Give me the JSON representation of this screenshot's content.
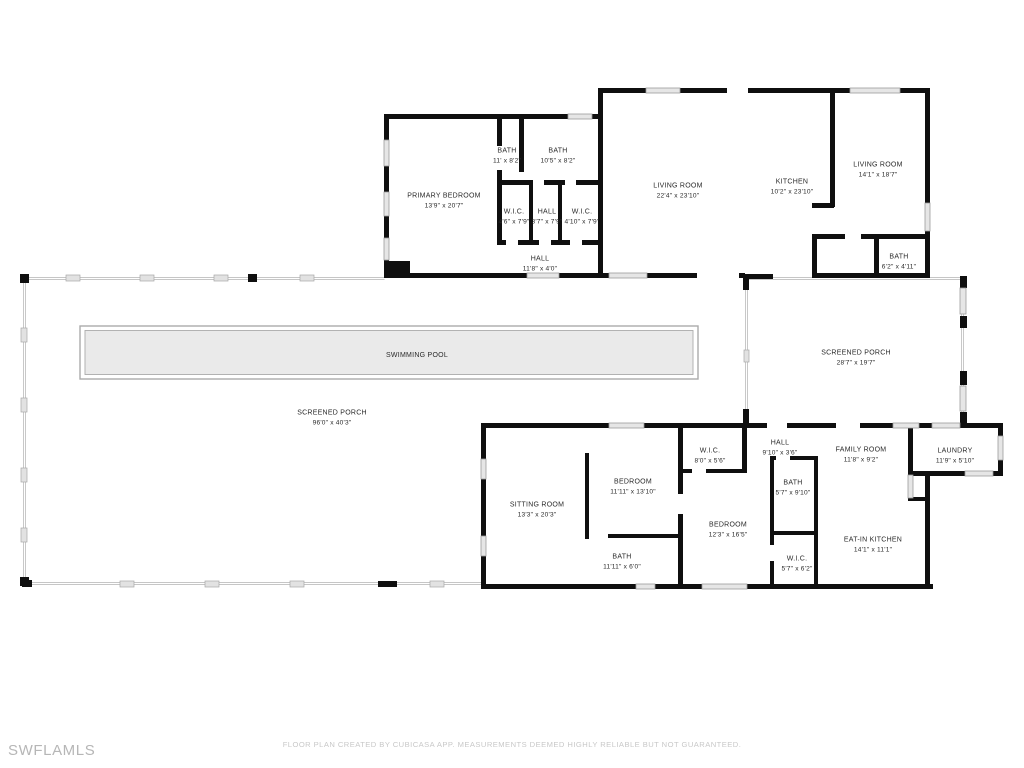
{
  "meta": {
    "watermark": "SWFLAMLS",
    "disclaimer": "FLOOR PLAN CREATED BY CUBICASA APP. MEASUREMENTS DEEMED HIGHLY RELIABLE BUT NOT GUARANTEED."
  },
  "colors": {
    "wall": "#0f0f0f",
    "window": "#e6e6e6",
    "window-frame": "#9c9c9c",
    "screen": "#c6c6c6",
    "pool-fill": "#eaeaea",
    "pool-line": "#ababab",
    "label": "#2a2a2a",
    "muted": "#c8c8c8",
    "watermark": "#b6b6b6",
    "bg": "#ffffff"
  },
  "rooms": [
    {
      "id": "primary-bedroom",
      "name": "PRIMARY BEDROOM",
      "dims": "13'9\" x 20'7\""
    },
    {
      "id": "bath-1",
      "name": "BATH",
      "dims": "11' x 8'2\""
    },
    {
      "id": "bath-2",
      "name": "BATH",
      "dims": "10'5\" x 8'2\""
    },
    {
      "id": "wic-1",
      "name": "W.I.C.",
      "dims": "4'6\" x 7'9\""
    },
    {
      "id": "hall-1",
      "name": "HALL",
      "dims": "3'7\" x 7'9\""
    },
    {
      "id": "wic-2",
      "name": "W.I.C.",
      "dims": "4'10\" x 7'9\""
    },
    {
      "id": "living-room-1",
      "name": "LIVING ROOM",
      "dims": "22'4\" x 23'10\""
    },
    {
      "id": "kitchen",
      "name": "KITCHEN",
      "dims": "10'2\" x 23'10\""
    },
    {
      "id": "living-room-2",
      "name": "LIVING ROOM",
      "dims": "14'1\" x 18'7\""
    },
    {
      "id": "bath-3",
      "name": "BATH",
      "dims": "6'2\" x 4'11\""
    },
    {
      "id": "hall-2",
      "name": "HALL",
      "dims": "11'8\" x 4'0\""
    },
    {
      "id": "swimming-pool",
      "name": "SWIMMING POOL",
      "dims": ""
    },
    {
      "id": "screened-porch-1",
      "name": "SCREENED PORCH",
      "dims": "96'0\" x 40'3\""
    },
    {
      "id": "screened-porch-2",
      "name": "SCREENED PORCH",
      "dims": "28'7\" x 19'7\""
    },
    {
      "id": "wic-3",
      "name": "W.I.C.",
      "dims": "8'0\" x 5'6\""
    },
    {
      "id": "hall-3",
      "name": "HALL",
      "dims": "9'10\" x 3'6\""
    },
    {
      "id": "family-room",
      "name": "FAMILY ROOM",
      "dims": "11'8\" x 9'2\""
    },
    {
      "id": "laundry",
      "name": "LAUNDRY",
      "dims": "11'9\" x 5'10\""
    },
    {
      "id": "bedroom-1",
      "name": "BEDROOM",
      "dims": "11'11\" x 13'10\""
    },
    {
      "id": "sitting-room",
      "name": "SITTING ROOM",
      "dims": "13'3\" x 20'3\""
    },
    {
      "id": "bath-4",
      "name": "BATH",
      "dims": "5'7\" x 9'10\""
    },
    {
      "id": "bedroom-2",
      "name": "BEDROOM",
      "dims": "12'3\" x 16'5\""
    },
    {
      "id": "bath-5",
      "name": "BATH",
      "dims": "11'11\" x 6'0\""
    },
    {
      "id": "wic-4",
      "name": "W.I.C.",
      "dims": "5'7\" x 6'2\""
    },
    {
      "id": "eat-in-kitchen",
      "name": "EAT-IN KITCHEN",
      "dims": "14'1\" x 11'1\""
    }
  ]
}
